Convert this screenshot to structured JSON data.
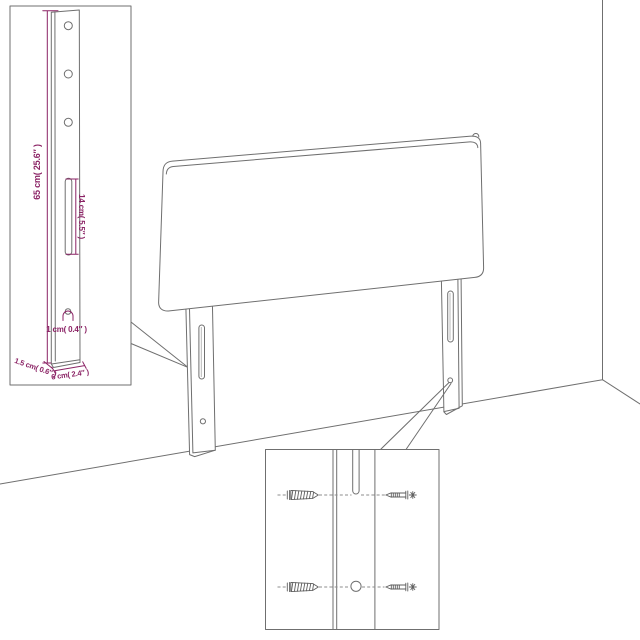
{
  "page": {
    "description": "Headboard with legs dimension and assembly diagram",
    "background": "#ffffff"
  },
  "colors": {
    "outline": "#6f6f6f",
    "dimension": "#8b2365"
  },
  "labels": {
    "leg_height": "65 cm( 25.6″ )",
    "slot_length": "14 cm( 5.5″ )",
    "hole_diameter": "1 cm( 0.4″ )",
    "leg_depth": "1.5 cm( 0.6″ )",
    "leg_width": "6 cm( 2.4″ )"
  }
}
